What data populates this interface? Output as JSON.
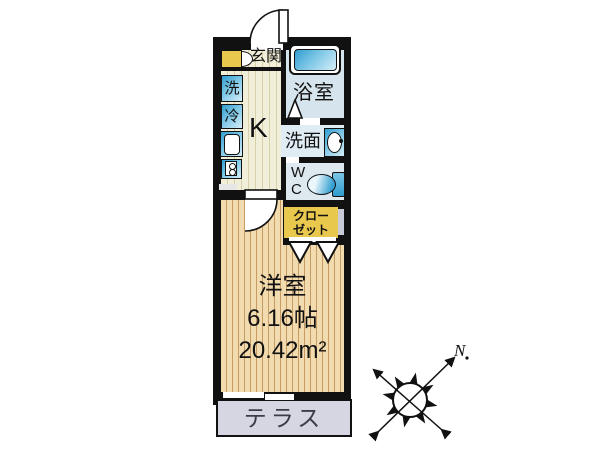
{
  "floorplan": {
    "title": "1K apartment floor plan",
    "labels": {
      "genkan": "玄関",
      "washer": "洗",
      "fridge": "冷",
      "kitchen": "K",
      "bath": "浴室",
      "washroom": "洗面",
      "wc_line1": "W",
      "wc_line2": "C",
      "closet_line1": "クロー",
      "closet_line2": "ゼット",
      "main_room": "洋室",
      "main_room_size_jo": "6.16帖",
      "main_room_size_m2": "20.42m²",
      "terrace": "テラス",
      "compass_north": "N"
    },
    "colors": {
      "wall": "#111111",
      "kitchen_floor": "#f1eeda",
      "wood_floor": "#f3dbb0",
      "wood_stripe": "#c59c64",
      "bath_floor": "#d6e4ed",
      "washroom_floor": "#dfecf3",
      "closet_yellow": "#e9c84e",
      "terrace_gray": "#d6d6e3",
      "fixture_blue_dark": "#2f9dcf",
      "fixture_blue_light": "#d6eef8"
    }
  }
}
